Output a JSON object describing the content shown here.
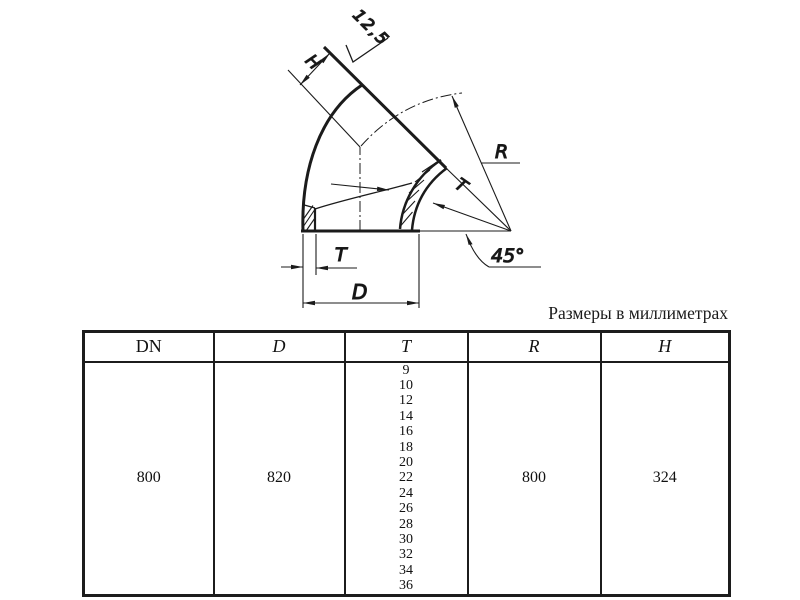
{
  "caption": "Размеры в миллиметрах",
  "drawing": {
    "labels": {
      "roughness": "12,5",
      "height": "H",
      "radius": "R",
      "thickness_section": "T",
      "thickness_bottom": "T",
      "diameter": "D",
      "angle": "45°"
    }
  },
  "table": {
    "headers": [
      "DN",
      "D",
      "T",
      "R",
      "H"
    ],
    "row": {
      "dn": "800",
      "d": "820",
      "t_values": [
        "9",
        "10",
        "12",
        "14",
        "16",
        "18",
        "20",
        "22",
        "24",
        "26",
        "28",
        "30",
        "32",
        "34",
        "36"
      ],
      "r": "800",
      "h": "324"
    }
  }
}
